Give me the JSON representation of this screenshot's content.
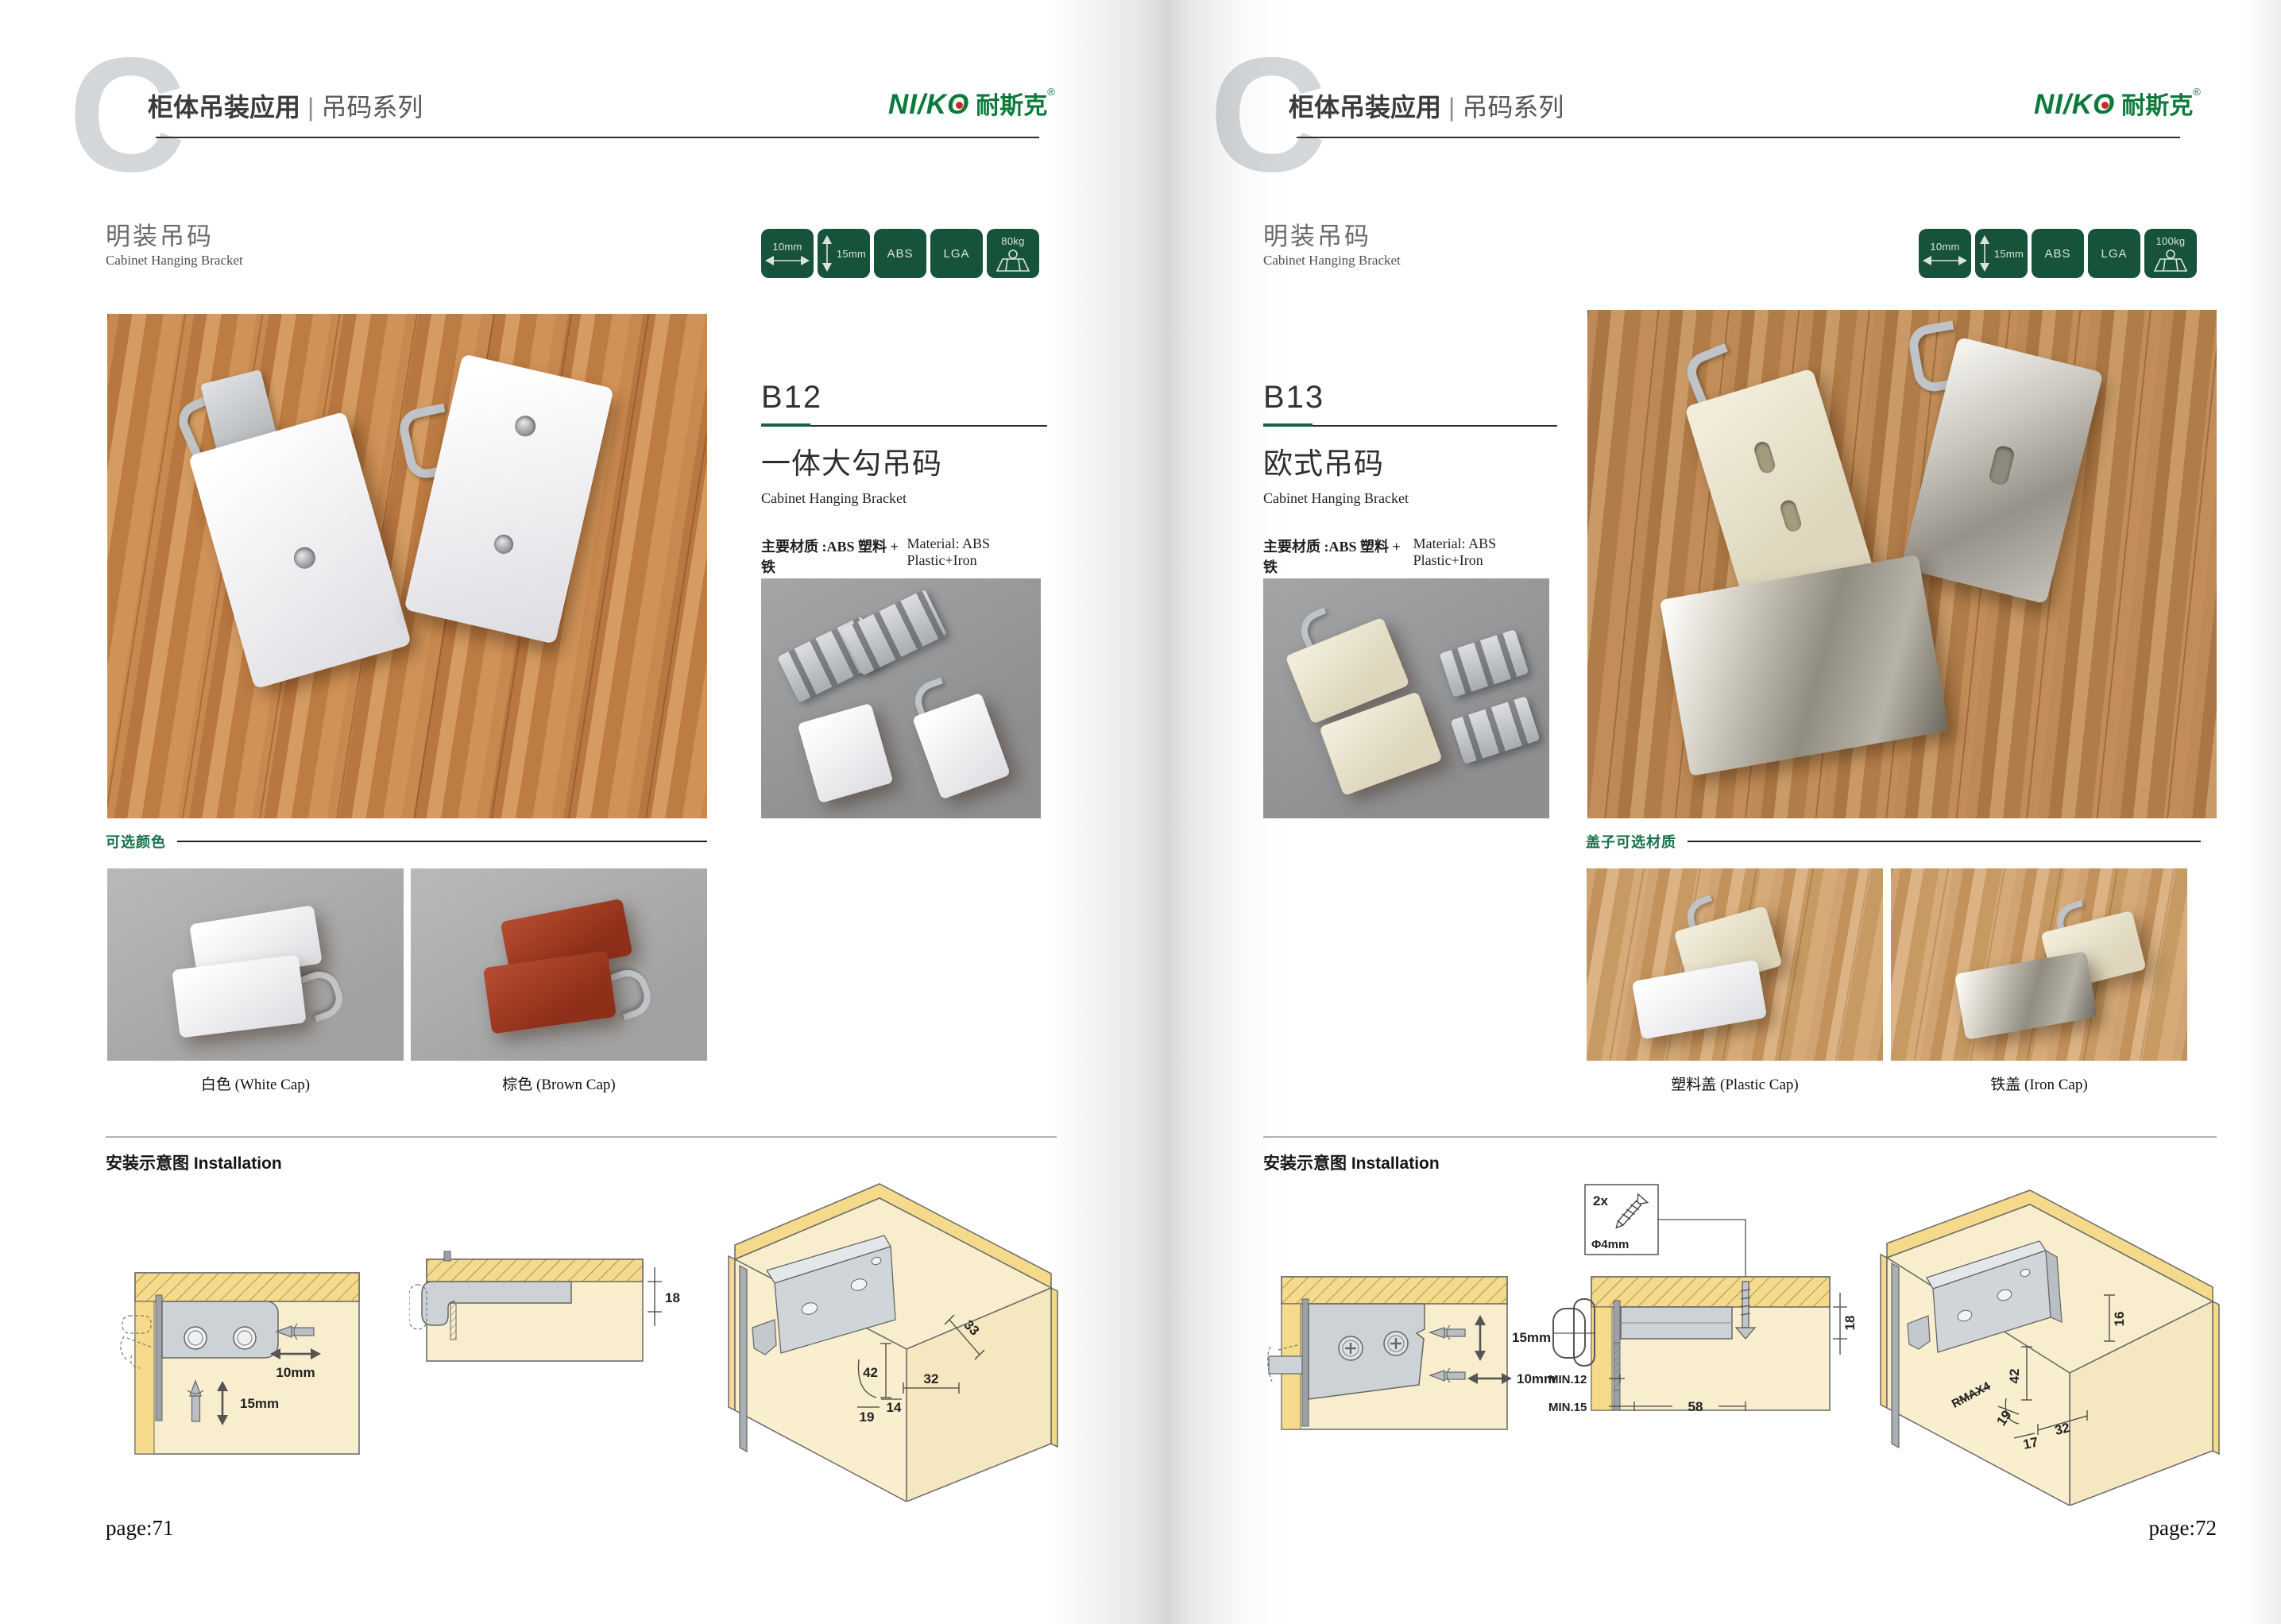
{
  "brand": {
    "logo_text": "NI/KO",
    "logo_cn": "耐斯克",
    "logo_reg": "®",
    "colors": {
      "logo_green": "#0c7a3b",
      "badge_green": "#17523a",
      "accent_green": "#1c6143",
      "logo_dot_red": "#cc2a1a"
    }
  },
  "pages": [
    {
      "page_label": "page:71",
      "watermark_letter": "C",
      "header": {
        "category": "柜体吊装应用",
        "divider": "|",
        "series": "吊码系列"
      },
      "section": {
        "title_zh": "明装吊码",
        "title_en": "Cabinet Hanging Bracket"
      },
      "badges": [
        {
          "label": "10mm",
          "icon": "horizontal-arrow"
        },
        {
          "label": "15mm",
          "icon": "vertical-arrow"
        },
        {
          "label": "ABS",
          "icon": "none"
        },
        {
          "label": "LGA",
          "icon": "none"
        },
        {
          "label": "80kg",
          "icon": "load-trapezoid"
        }
      ],
      "product": {
        "code": "B12",
        "name_zh": "一体大勾吊码",
        "name_en": "Cabinet Hanging Bracket",
        "material_zh": "主要材质 :ABS 塑料 + 铁",
        "material_en": "Material: ABS Plastic+Iron",
        "finish_zh": "表面处理 : 白色、棕色",
        "finish_en": "Finish:White,Brown"
      },
      "options": {
        "title": "可选颜色",
        "items": [
          {
            "caption": "白色 (White Cap)"
          },
          {
            "caption": "棕色 (Brown Cap)"
          }
        ]
      },
      "installation": {
        "title": "安装示意图 Installation",
        "diagram1": {
          "width_label": "10mm",
          "height_label": "15mm"
        },
        "diagram2": {
          "thickness_label": "18"
        },
        "diagram3": {
          "dim_33": "33",
          "dim_42": "42",
          "dim_32": "32",
          "dim_14": "14",
          "dim_19": "19"
        }
      }
    },
    {
      "page_label": "page:72",
      "watermark_letter": "C",
      "header": {
        "category": "柜体吊装应用",
        "divider": "|",
        "series": "吊码系列"
      },
      "section": {
        "title_zh": "明装吊码",
        "title_en": "Cabinet Hanging Bracket"
      },
      "badges": [
        {
          "label": "10mm",
          "icon": "horizontal-arrow"
        },
        {
          "label": "15mm",
          "icon": "vertical-arrow"
        },
        {
          "label": "ABS",
          "icon": "none"
        },
        {
          "label": "LGA",
          "icon": "none"
        },
        {
          "label": "100kg",
          "icon": "load-trapezoid"
        }
      ],
      "product": {
        "code": "B13",
        "name_zh": "欧式吊码",
        "name_en": "Cabinet Hanging Bracket",
        "material_zh": "主要材质 :ABS 塑料 + 铁",
        "material_en": "Material: ABS Plastic+Iron",
        "finish_zh": "表面处理 : 镀镍",
        "finish_en": "Finish:Nickel plating"
      },
      "options": {
        "title": "盖子可选材质",
        "items": [
          {
            "caption": "塑料盖 (Plastic Cap)"
          },
          {
            "caption": "铁盖 (Iron Cap)"
          }
        ]
      },
      "installation": {
        "title": "安装示意图 Installation",
        "diagram1": {
          "height_label": "15mm",
          "width_label": "10mm"
        },
        "diagram2": {
          "screw_count": "2x",
          "screw_dia": "Φ4mm",
          "thickness_label": "18",
          "min1": "MIN.12",
          "min2": "MIN.15",
          "width_label": "58"
        },
        "diagram3": {
          "dim_16": "16",
          "dim_42": "42",
          "dim_rmax": "RMAX4",
          "dim_19": "19",
          "dim_17": "17",
          "dim_32": "32"
        }
      }
    }
  ]
}
